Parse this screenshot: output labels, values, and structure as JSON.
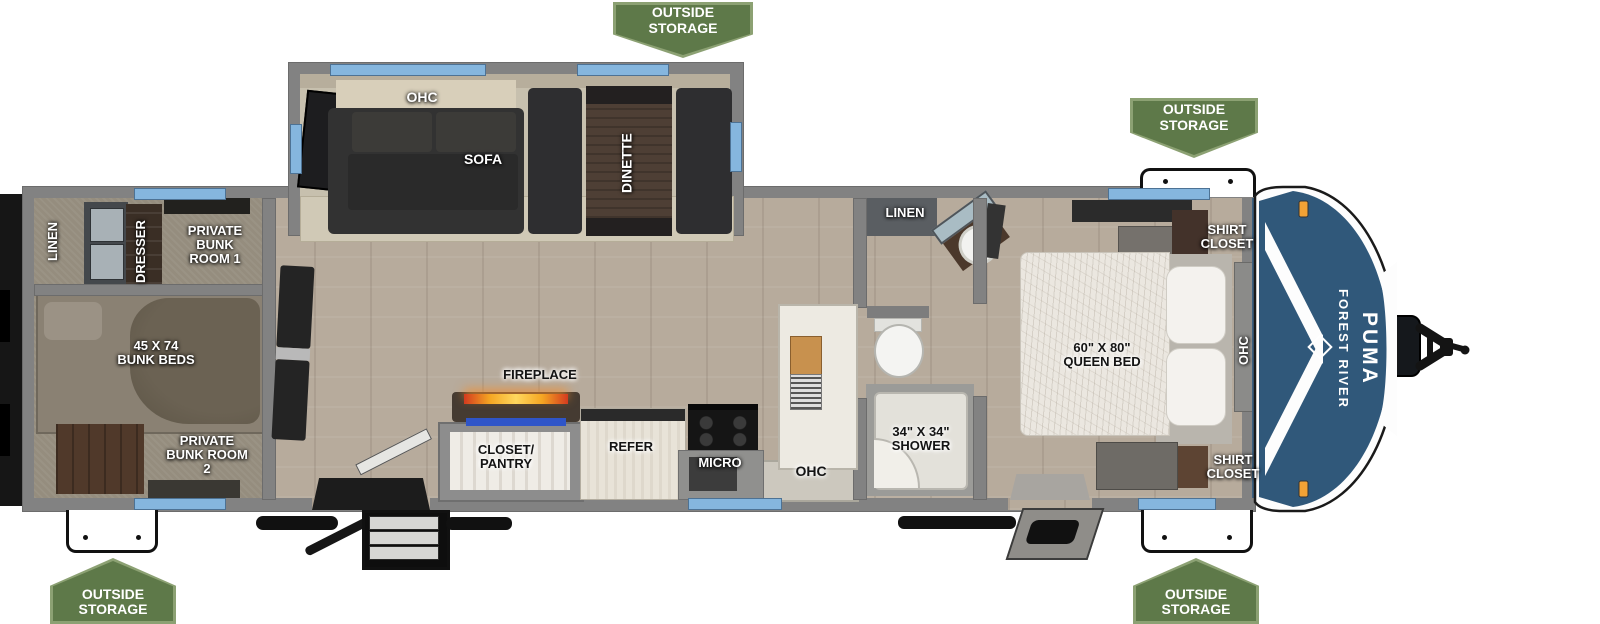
{
  "brand": {
    "maker": "FOREST RIVER",
    "model": "PUMA"
  },
  "badges": [
    {
      "position": "top-center",
      "label": "OUTSIDE STORAGE"
    },
    {
      "position": "top-right",
      "label": "OUTSIDE STORAGE"
    },
    {
      "position": "bottom-left",
      "label": "OUTSIDE STORAGE"
    },
    {
      "position": "bottom-right",
      "label": "OUTSIDE STORAGE"
    }
  ],
  "slideout": {
    "ohc": "OHC",
    "sofa": "SOFA",
    "dinette": "DINETTE"
  },
  "rear_bunkhouse": {
    "linen": "LINEN",
    "dresser": "DRESSER",
    "bunk_room_1": "PRIVATE BUNK ROOM 1",
    "bunk_beds": "45 X 74 BUNK BEDS",
    "bunk_room_2": "PRIVATE BUNK ROOM 2"
  },
  "kitchen": {
    "fireplace": "FIREPLACE",
    "closet_pantry": "CLOSET/ PANTRY",
    "refer": "REFER",
    "micro": "MICRO",
    "ohc": "OHC"
  },
  "bathroom": {
    "linen": "LINEN",
    "shower": "34\" X 34\" SHOWER"
  },
  "bedroom": {
    "queen_bed": "60\" X 80\" QUEEN BED",
    "shirt_closet_top": "SHIRT CLOSET",
    "shirt_closet_bottom": "SHIRT CLOSET",
    "ohc": "OHC"
  },
  "colors": {
    "badge_green": "#5e7949",
    "badge_border": "#8ca173",
    "window_blue": "#85b6de",
    "cap_blue": "#30587a",
    "clearance_light_orange": "#f2a235",
    "fireplace_accent_blue": "#2f55c8"
  }
}
